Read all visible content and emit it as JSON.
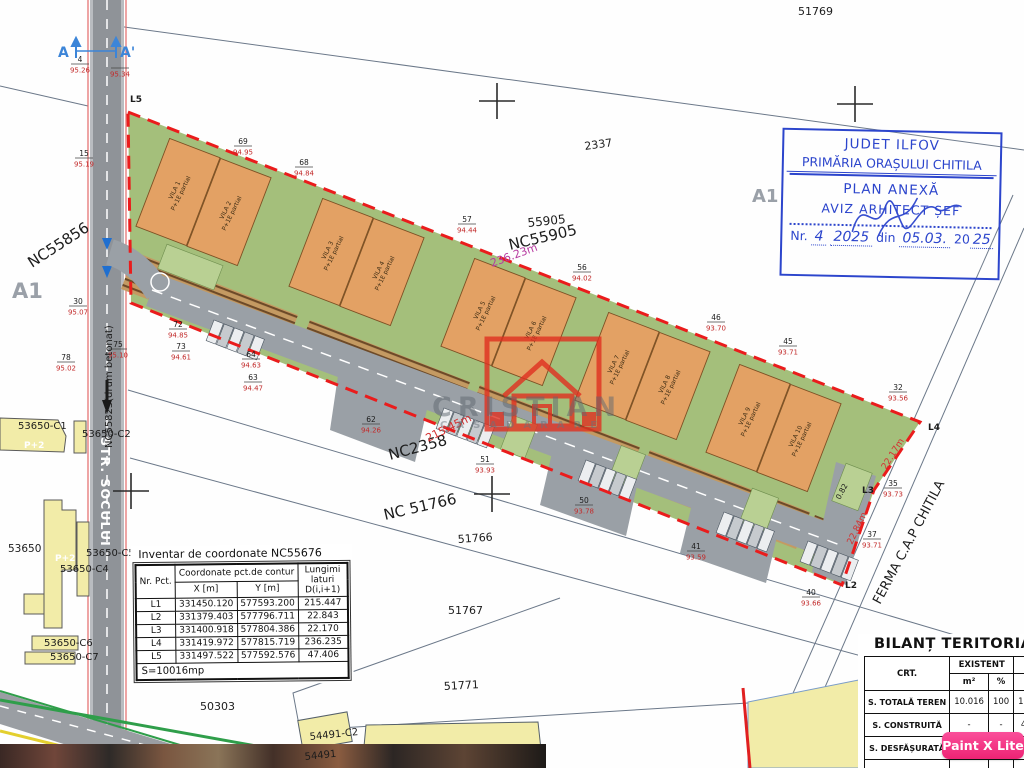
{
  "map_labels": [
    {
      "t": "51769",
      "x": 798,
      "y": 15,
      "s": 11
    },
    {
      "t": "2337",
      "x": 585,
      "y": 150,
      "r": -8,
      "s": 11
    },
    {
      "t": "55905",
      "x": 528,
      "y": 227,
      "r": -6,
      "s": 12
    },
    {
      "t": "NC55905",
      "x": 510,
      "y": 250,
      "r": -13,
      "s": 15
    },
    {
      "t": "236.23m",
      "x": 492,
      "y": 267,
      "r": -20,
      "s": 11,
      "c": "#b73aa0"
    },
    {
      "t": "NC2358",
      "x": 390,
      "y": 460,
      "r": -15,
      "s": 15
    },
    {
      "t": "215.45m",
      "x": 428,
      "y": 442,
      "r": -26,
      "s": 11,
      "c": "#d43030"
    },
    {
      "t": "NC 51766",
      "x": 385,
      "y": 520,
      "r": -13,
      "s": 15
    },
    {
      "t": "51766",
      "x": 458,
      "y": 543,
      "r": -4,
      "s": 11
    },
    {
      "t": "51767",
      "x": 448,
      "y": 614,
      "s": 11
    },
    {
      "t": "51771",
      "x": 444,
      "y": 690,
      "r": -3,
      "s": 11
    },
    {
      "t": "50303",
      "x": 200,
      "y": 710,
      "s": 11
    },
    {
      "t": "NC55856",
      "x": 32,
      "y": 268,
      "r": -33,
      "s": 15
    },
    {
      "t": "A1",
      "x": 12,
      "y": 298,
      "s": 21,
      "c": "#9aa0a8",
      "w": "bold"
    },
    {
      "t": "A1",
      "x": 752,
      "y": 202,
      "s": 18,
      "c": "#9aa0a8",
      "w": "bold"
    },
    {
      "t": "FERMA C.A.P CHITILA",
      "x": 880,
      "y": 605,
      "r": -62,
      "s": 13
    },
    {
      "t": "22.17m",
      "x": 886,
      "y": 470,
      "r": -58,
      "s": 9,
      "c": "#d43030"
    },
    {
      "t": "22.84m",
      "x": 852,
      "y": 545,
      "r": -64,
      "s": 9,
      "c": "#d43030"
    },
    {
      "t": "0.82",
      "x": 840,
      "y": 500,
      "r": -62,
      "s": 7.5
    },
    {
      "t": "53650-C1",
      "x": 18,
      "y": 429,
      "s": 10
    },
    {
      "t": "53650-C2",
      "x": 82,
      "y": 437,
      "s": 10
    },
    {
      "t": "53650",
      "x": 8,
      "y": 552,
      "s": 10.5
    },
    {
      "t": "53650-C5",
      "x": 86,
      "y": 556,
      "s": 10
    },
    {
      "t": "53650-C4",
      "x": 60,
      "y": 572,
      "s": 10
    },
    {
      "t": "53650-C6",
      "x": 44,
      "y": 646,
      "s": 10
    },
    {
      "t": "53650-C7",
      "x": 50,
      "y": 660,
      "s": 10
    },
    {
      "t": "P+2",
      "x": 24,
      "y": 448,
      "s": 9,
      "c": "#ffffff",
      "w": "bold"
    },
    {
      "t": "P+2",
      "x": 55,
      "y": 561,
      "s": 9,
      "c": "#ffffff",
      "w": "bold"
    },
    {
      "t": "54491-C2",
      "x": 310,
      "y": 740,
      "r": -6,
      "s": 10
    },
    {
      "t": "54491",
      "x": 305,
      "y": 760,
      "r": -6,
      "s": 10
    },
    {
      "t": "STR. SOCULUI",
      "x": 101,
      "y": 437,
      "r": 90,
      "s": 12.5,
      "c": "#ffffff",
      "w": "bold",
      "ls": 1
    },
    {
      "t": "NC55823(drum betonat)",
      "x": 112,
      "y": 448,
      "r": -90,
      "s": 10
    },
    {
      "t": "L5",
      "x": 130,
      "y": 102,
      "s": 9,
      "w": "bold"
    },
    {
      "t": "L4",
      "x": 928,
      "y": 430,
      "s": 9,
      "w": "bold"
    },
    {
      "t": "L3",
      "x": 862,
      "y": 493,
      "s": 9,
      "w": "bold"
    },
    {
      "t": "L2",
      "x": 845,
      "y": 588,
      "s": 9,
      "w": "bold"
    },
    {
      "t": "A",
      "x": 58,
      "y": 57,
      "s": 14,
      "c": "#3c85d8",
      "w": "bold"
    },
    {
      "t": "A'",
      "x": 120,
      "y": 57,
      "s": 14,
      "c": "#3c85d8",
      "w": "bold"
    }
  ],
  "survey_points": [
    {
      "id": "4",
      "elev": "95.26",
      "x": 80,
      "y": 64
    },
    {
      "id": "",
      "elev": "95.34",
      "x": 120,
      "y": 68
    },
    {
      "id": "15",
      "elev": "95.19",
      "x": 84,
      "y": 158
    },
    {
      "id": "30",
      "elev": "95.07",
      "x": 78,
      "y": 306
    },
    {
      "id": "78",
      "elev": "95.02",
      "x": 66,
      "y": 362
    },
    {
      "id": "75",
      "elev": "95.10",
      "x": 118,
      "y": 349
    },
    {
      "id": "69",
      "elev": "94.95",
      "x": 243,
      "y": 146
    },
    {
      "id": "68",
      "elev": "94.84",
      "x": 304,
      "y": 167
    },
    {
      "id": "57",
      "elev": "94.44",
      "x": 467,
      "y": 224
    },
    {
      "id": "56",
      "elev": "94.02",
      "x": 582,
      "y": 272
    },
    {
      "id": "46",
      "elev": "93.70",
      "x": 716,
      "y": 322
    },
    {
      "id": "45",
      "elev": "93.71",
      "x": 788,
      "y": 346
    },
    {
      "id": "32",
      "elev": "93.56",
      "x": 898,
      "y": 392
    },
    {
      "id": "35",
      "elev": "93.73",
      "x": 893,
      "y": 488
    },
    {
      "id": "37",
      "elev": "93.71",
      "x": 872,
      "y": 539
    },
    {
      "id": "40",
      "elev": "93.66",
      "x": 811,
      "y": 597
    },
    {
      "id": "41",
      "elev": "93.59",
      "x": 696,
      "y": 551
    },
    {
      "id": "50",
      "elev": "93.78",
      "x": 584,
      "y": 505
    },
    {
      "id": "51",
      "elev": "93.93",
      "x": 485,
      "y": 464
    },
    {
      "id": "62",
      "elev": "94.26",
      "x": 371,
      "y": 424
    },
    {
      "id": "63",
      "elev": "94.47",
      "x": 253,
      "y": 382
    },
    {
      "id": "64",
      "elev": "94.63",
      "x": 251,
      "y": 359
    },
    {
      "id": "72",
      "elev": "94.85",
      "x": 178,
      "y": 329
    },
    {
      "id": "73",
      "elev": "94.61",
      "x": 181,
      "y": 351
    }
  ],
  "villas": [
    {
      "name": "VILA 1",
      "spec": "P+1E partial",
      "x": 178,
      "y": 192
    },
    {
      "name": "VILA 2",
      "spec": "P+1E partial",
      "x": 229,
      "y": 212
    },
    {
      "name": "VILA 3",
      "spec": "P+1E partial",
      "x": 331,
      "y": 252
    },
    {
      "name": "VILA 4",
      "spec": "P+1E partial",
      "x": 382,
      "y": 272
    },
    {
      "name": "VILA 5",
      "spec": "P+1E partial",
      "x": 483,
      "y": 312
    },
    {
      "name": "VILA 6",
      "spec": "P+1E partial",
      "x": 534,
      "y": 332
    },
    {
      "name": "VILA 7",
      "spec": "P+1E partial",
      "x": 617,
      "y": 366
    },
    {
      "name": "VILA 8",
      "spec": "P+1E partial",
      "x": 668,
      "y": 386
    },
    {
      "name": "VILA 9",
      "spec": "P+1E partial",
      "x": 748,
      "y": 418
    },
    {
      "name": "VILA 10",
      "spec": "P+1E partial",
      "x": 799,
      "y": 438
    }
  ],
  "stamp": {
    "line1": "JUDET ILFOV",
    "line2": "PRIMĂRIA ORAȘULUI CHITILA",
    "line3": "PLAN ANEXĂ",
    "line4": "AVIZ ARHITECT ȘEF",
    "nr_prefix": "Nr.",
    "nr_value": "4",
    "nr_year": "2025",
    "nr_din": "din",
    "nr_date": "05.03.",
    "nr_year2": "20",
    "nr_year2_hand": "25"
  },
  "coord_table": {
    "title": "Inventar de coordonate NC55676",
    "header": {
      "nr": "Nr. Pct.",
      "coord": "Coordonate pct.de contur",
      "x": "X [m]",
      "y": "Y [m]",
      "len": "Lungimi laturi D(i,i+1)"
    },
    "rows": [
      [
        "L1",
        "331450.120",
        "577593.200",
        "215.447"
      ],
      [
        "L2",
        "331379.403",
        "577796.711",
        "22.843"
      ],
      [
        "L3",
        "331400.918",
        "577804.386",
        "22.170"
      ],
      [
        "L4",
        "331419.972",
        "577815.719",
        "236.235"
      ],
      [
        "L5",
        "331497.522",
        "577592.576",
        "47.406"
      ]
    ],
    "footer": "S=10016mp"
  },
  "bilant_table": {
    "title": "BILANȚ TERITORIAL",
    "col_headers": {
      "crt": "CRT.",
      "existent": "EXISTENT",
      "propus": "PROPUS",
      "m2": "m²",
      "pct": "%"
    },
    "rows": [
      {
        "label": "S. TOTALĂ TEREN",
        "e_m2": "10.016",
        "e_pct": "100",
        "p_m2": "10.016",
        "p_pct": "100"
      },
      {
        "label": "S. CONSTRUITĂ",
        "e_m2": "-",
        "e_pct": "-",
        "p_m2": "4.600",
        "p_pct": "46"
      },
      {
        "label": "S. DESFĂȘURATĂ",
        "e_m2": "-",
        "e_pct": "-",
        "p_m2": "5.800",
        "p_pct": "58"
      },
      {
        "label": "P.O.T.",
        "e_m2": "-",
        "e_pct": "-",
        "p_m2": "45",
        "p_pct": ""
      }
    ]
  },
  "watermark": {
    "name": "CRISTIAN",
    "tagline": "CASADARARE"
  },
  "badge_label": "Paint X Lite",
  "colors": {
    "boundary_red": "#ea1c1c",
    "villa_orange": "#e3a164",
    "site_green": "#a4bf7b",
    "stamp_blue": "#2c45cc",
    "badge_pink": "#ee2374",
    "road_gray": "#9aa0a6"
  }
}
